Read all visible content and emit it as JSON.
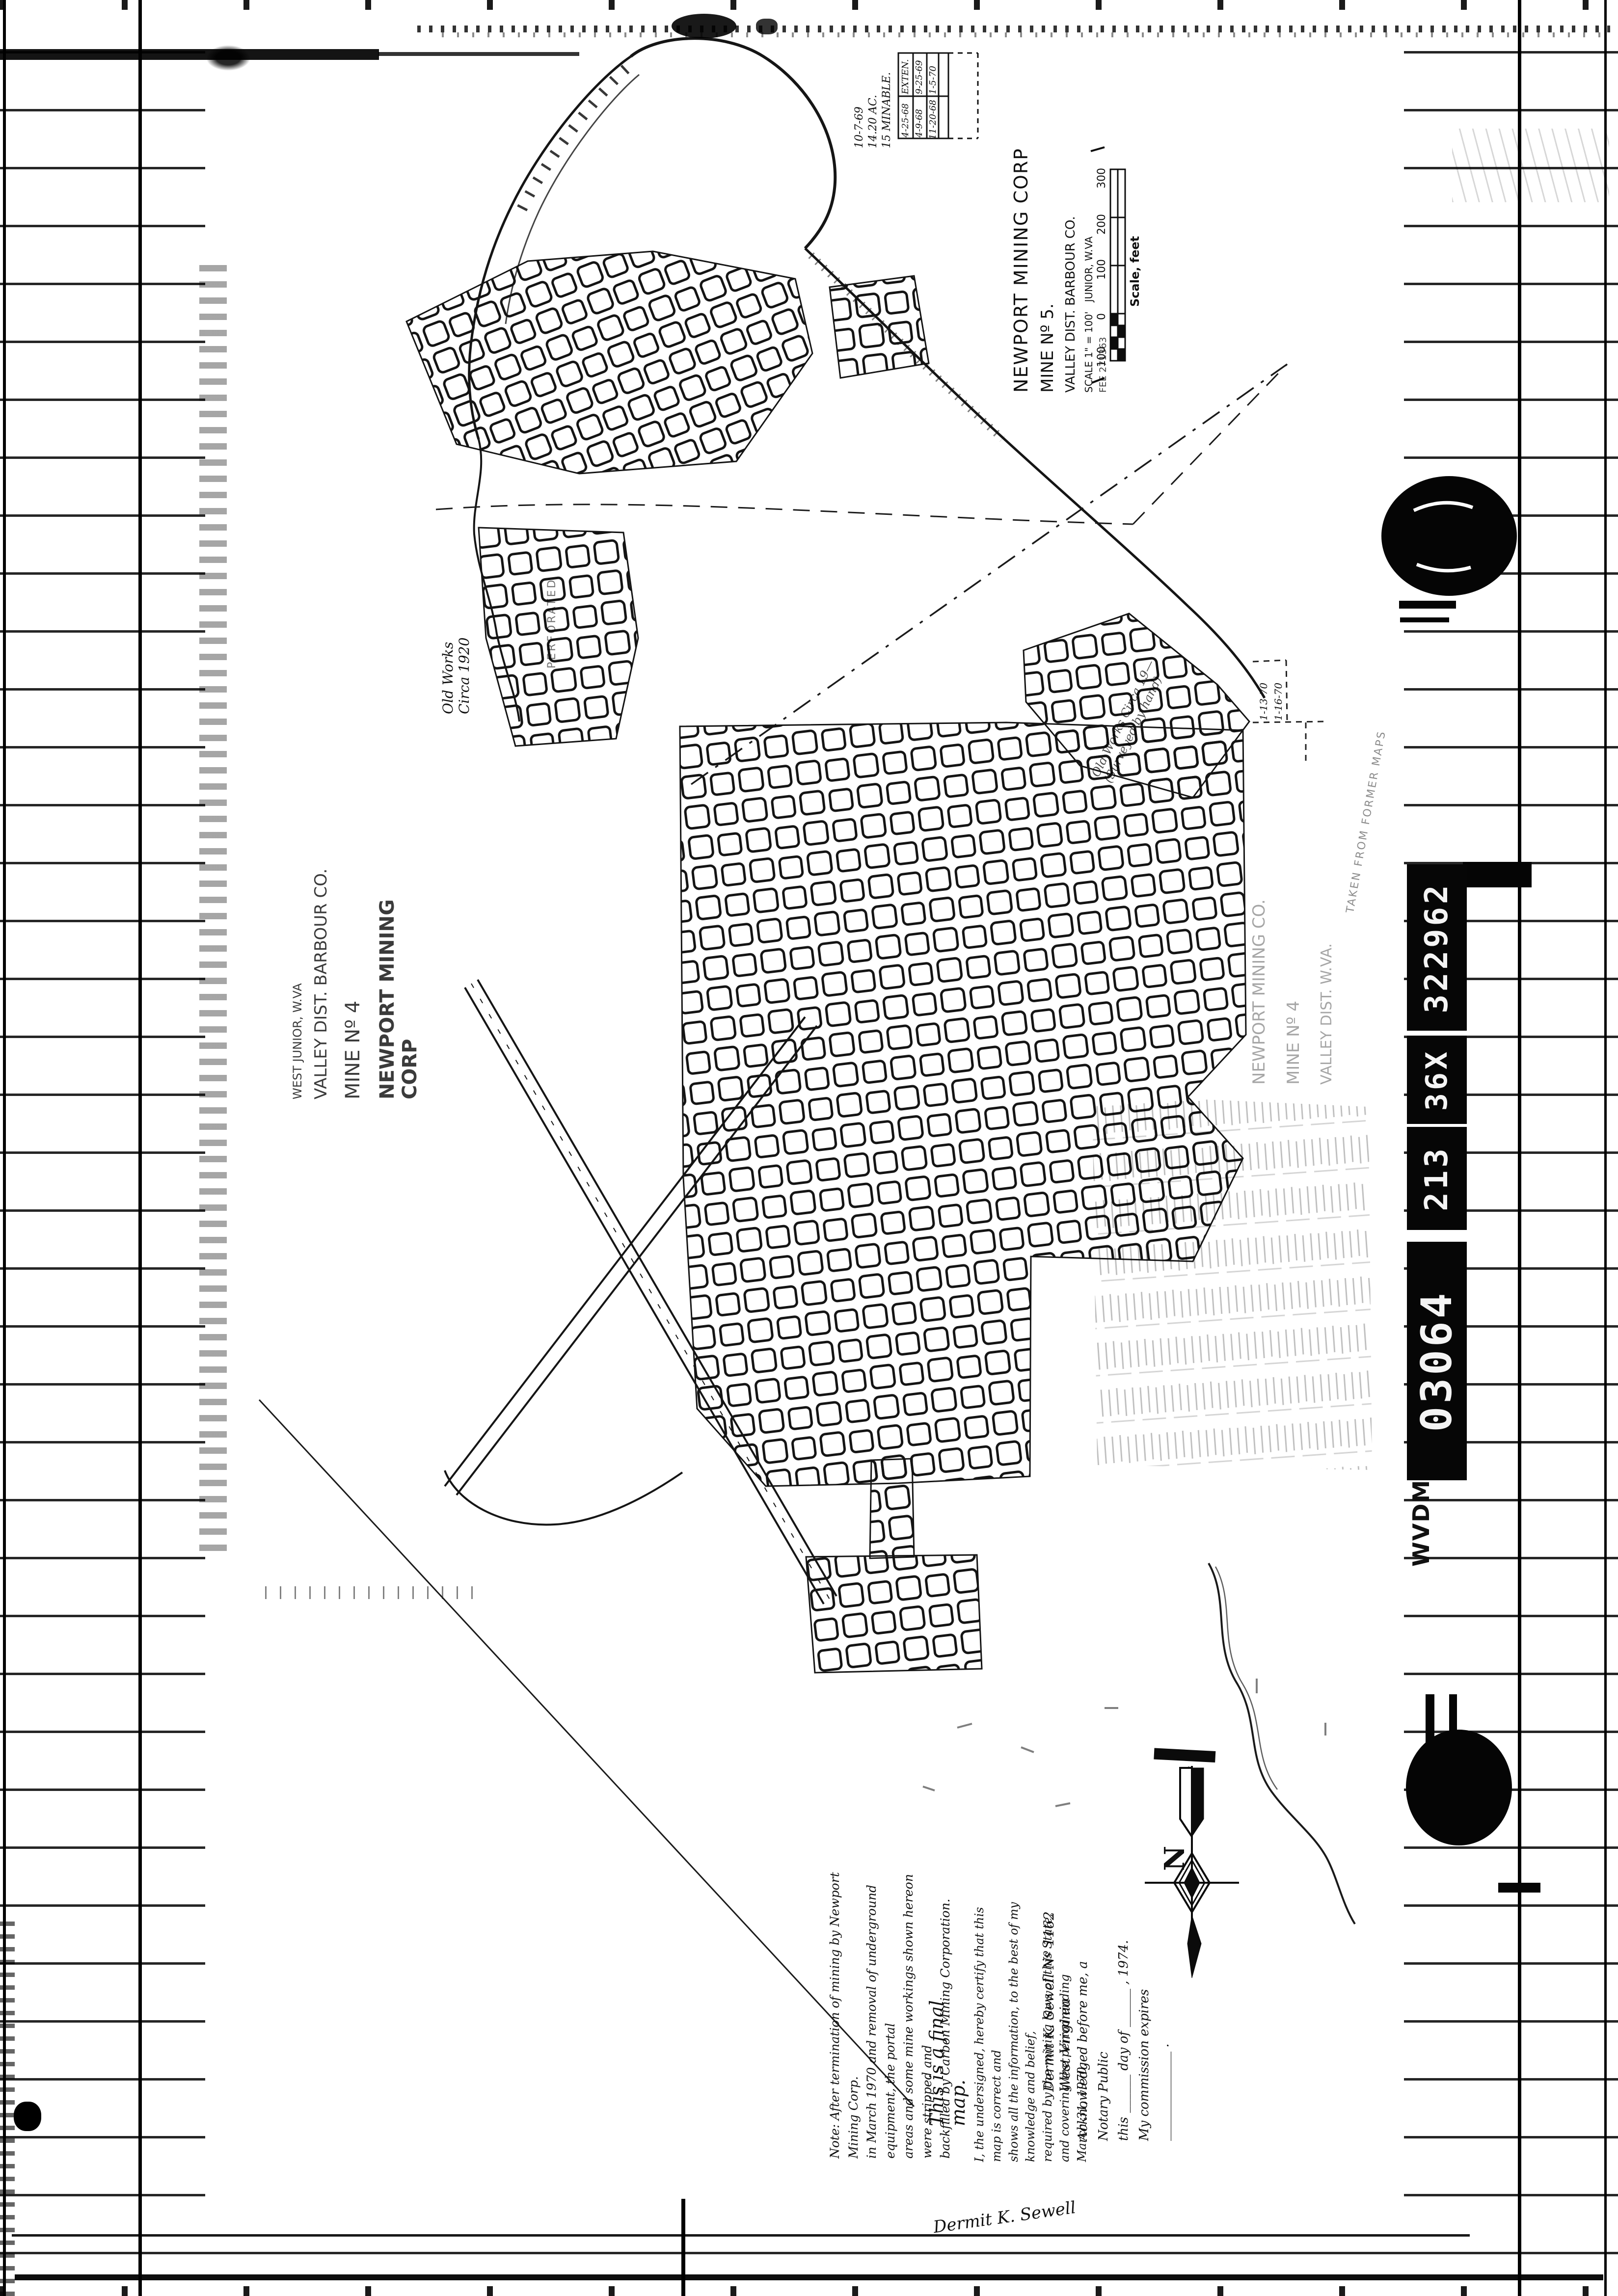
{
  "page": {
    "ink": "#111111",
    "paper": "#ffffff",
    "pencil_opacity": "0.38"
  },
  "film_strip": {
    "agency_code": "WVDM",
    "segments": [
      "322962",
      "36X",
      "213",
      "03064"
    ]
  },
  "title_block": {
    "company": "NEWPORT MINING CORP",
    "mine": "MINE Nº 5.",
    "district": "VALLEY DIST. BARBOUR CO.",
    "scale_note": "SCALE 1\" = 100'",
    "location": "JUNIOR, W.VA",
    "fee_note": "FEE 271363"
  },
  "scale_bar": {
    "tick_labels": [
      "300",
      "200",
      "100",
      "0",
      "100"
    ],
    "caption": "Scale, feet"
  },
  "revision_panel": {
    "annotations": [
      "10-7-69",
      "14.20 AC.",
      "15 MINABLE."
    ],
    "cells": [
      "EXTEN.",
      "9-25-69",
      "1-5-70",
      "4-25-68",
      "4-9-68",
      "11-20-68"
    ]
  },
  "extension_inset": {
    "dates": [
      "1-13-70",
      "1-16-70"
    ]
  },
  "pencil_titles": {
    "left_lines": [
      "WEST JUNIOR, W.VA",
      "VALLEY DIST. BARBOUR CO.",
      "MINE Nº 4",
      "NEWPORT MINING CORP"
    ],
    "right_lines": [
      "NEWPORT MINING CO.",
      "MINE Nº 4",
      "VALLEY DIST.  W.VA."
    ]
  },
  "map_labels": {
    "old_works_left_lines": [
      "Old Works",
      "Circa 1920"
    ],
    "perforated": "PERFORATED",
    "old_works_right_lines": [
      "Old Works Circa 19—",
      "(Surveyed by hand)"
    ],
    "taken_from": "TAKEN FROM FORMER MAPS"
  },
  "compass": {
    "label": "N"
  },
  "notes": {
    "termination_note_lines": [
      "Note: After termination of mining by Newport Mining Corp.",
      "in March 1970 and removal of underground equipment, the portal",
      "areas and some mine workings shown hereon were stripped and",
      "backfilled by Carbon Mining Corporation."
    ],
    "final_map": "This is a final map.",
    "certification_lines": [
      "I, the undersigned, hereby certify that this map is correct and",
      "shows all the information, to the best of my knowledge and belief,",
      "required by the mining laws of this State, and covering the period ending",
      "March 31, 1970."
    ],
    "certifier": "Dermit K. Sewell    Nº 1162    West Virginia",
    "notary_lines": [
      "Acknowledged before me, a Notary Public",
      "this ______ day of ______ , 1974.",
      "My commission expires ______________ ."
    ],
    "bottom_signature": "Dermit K. Sewell"
  }
}
